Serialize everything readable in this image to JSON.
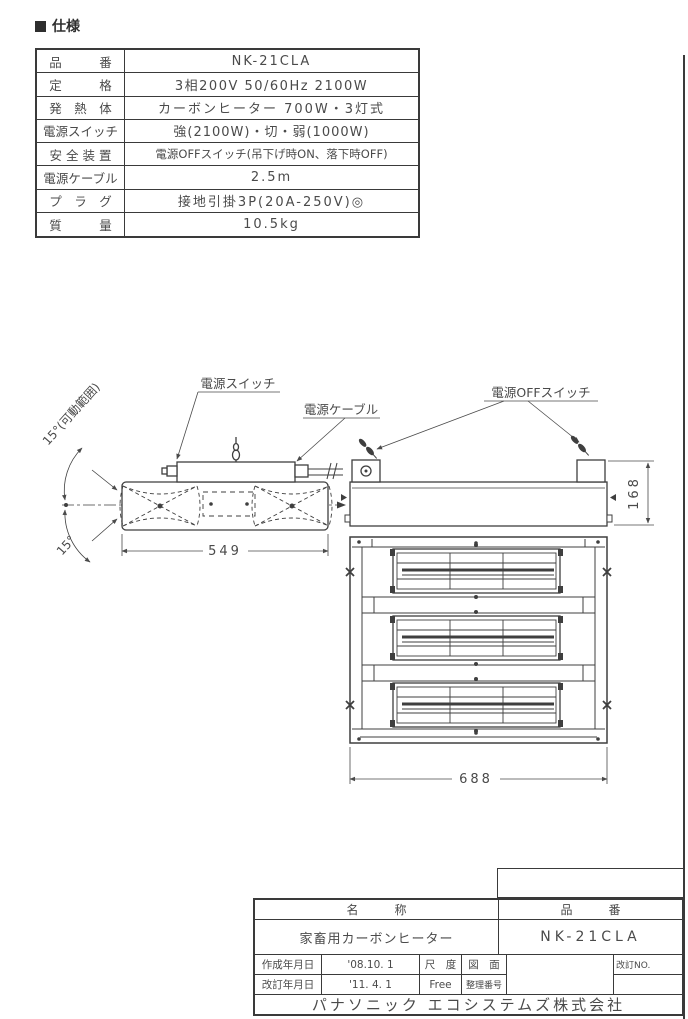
{
  "page": {
    "spec_section_title": "仕様"
  },
  "spec_table": {
    "rows": [
      {
        "label": "品　　　番",
        "value": "NK-21CLA"
      },
      {
        "label": "定　　　格",
        "value": "3相200V 50/60Hz 2100W"
      },
      {
        "label": "発　熱　体",
        "value": "カーボンヒーター 700W・3灯式"
      },
      {
        "label": "電源スイッチ",
        "value": "強(2100W)・切・弱(1000W)"
      },
      {
        "label": "安 全 装 置",
        "value": "電源OFFスイッチ(吊下げ時ON、落下時OFF)"
      },
      {
        "label": "電源ケーブル",
        "value": "2.5m"
      },
      {
        "label": "プ　ラ　グ",
        "value": "接地引掛3P(20A-250V)◎"
      },
      {
        "label": "質　　　量",
        "value": "10.5kg"
      }
    ]
  },
  "drawing": {
    "labels": {
      "power_switch": "電源スイッチ",
      "power_cable": "電源ケーブル",
      "power_off_switch": "電源OFFスイッチ",
      "tilt_range_top": "15°(可動範囲)",
      "tilt_range_bottom": "15°"
    },
    "dimensions": {
      "side_width": "549",
      "front_height": "168",
      "bottom_width": "688"
    }
  },
  "title_block": {
    "name_header": "名　　　称",
    "part_number_header": "品　　　番",
    "name_value": "家畜用カーボンヒーター",
    "part_number_value": "NK-21CLA",
    "created_label": "作成年月日",
    "created_value": "'08.10. 1",
    "revised_label": "改訂年月日",
    "revised_value": "'11. 4. 1",
    "scale_label": "尺　度",
    "scale_value": "Free",
    "drawing_no_label_top": "図　面",
    "drawing_no_label_bottom": "整理番号",
    "revision_no_label": "改訂NO.",
    "company": "パナソニック エコシステムズ株式会社"
  }
}
